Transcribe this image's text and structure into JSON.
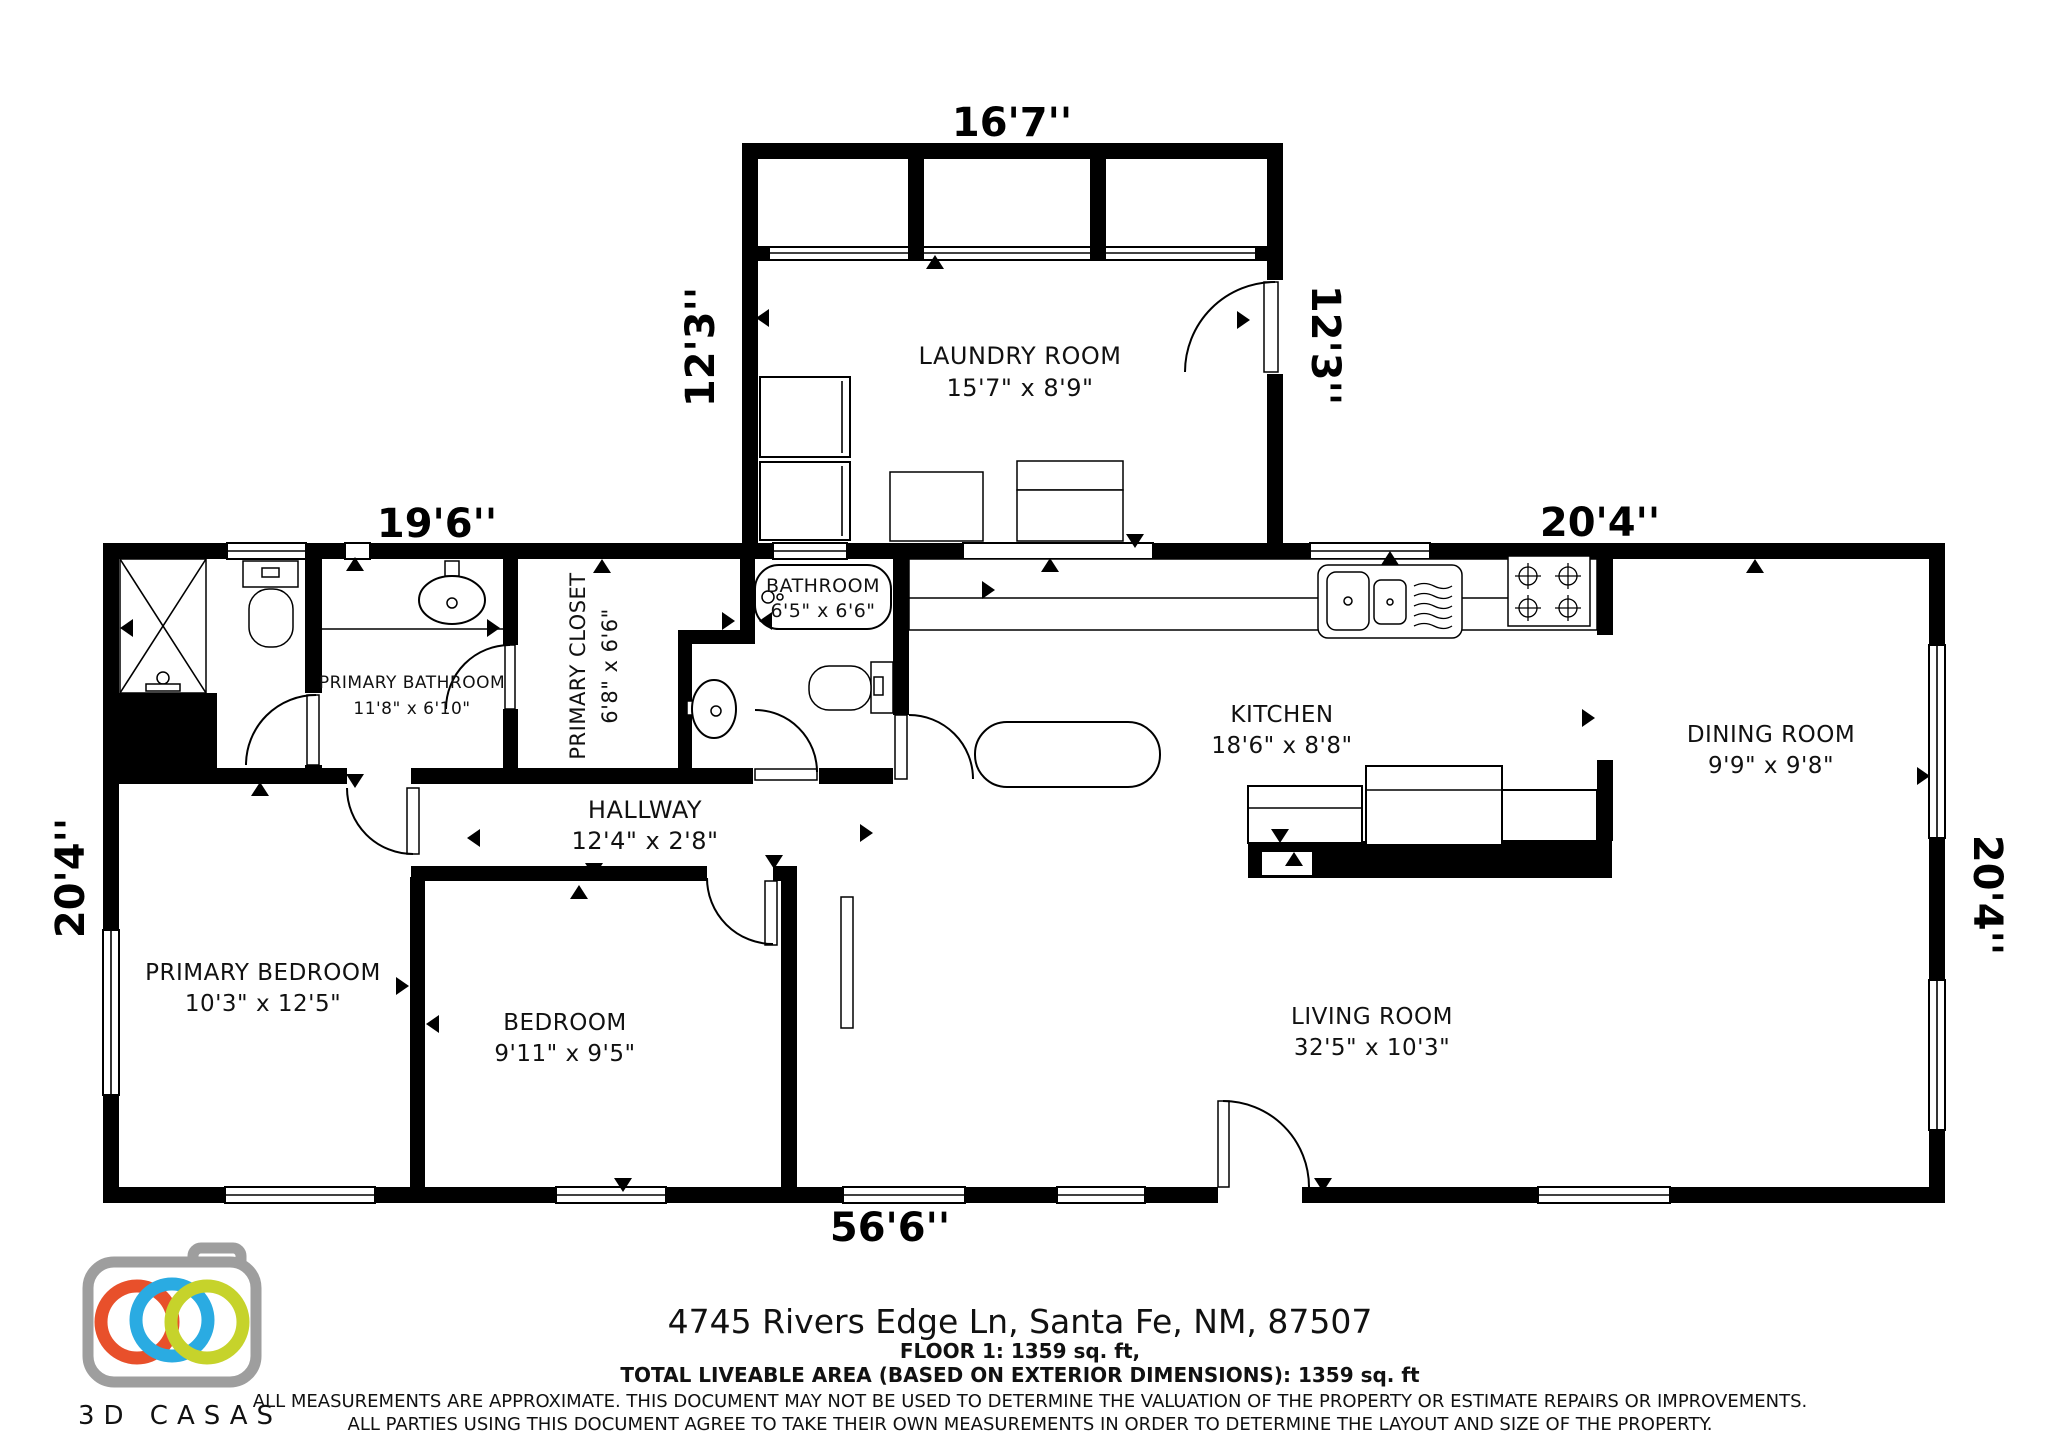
{
  "colors": {
    "wall": "#000000",
    "logo_gray": "#9e9e9e",
    "disclaimer": "#b5b5b5",
    "ring_orange": "#e8502b",
    "ring_blue": "#2aabe2",
    "ring_green": "#c6d32b"
  },
  "dimensions": {
    "laundry_top": "16'7''",
    "laundry_left": "12'3''",
    "laundry_right": "12'3''",
    "main_top_left": "19'6''",
    "main_top_right": "20'4''",
    "main_left": "20'4''",
    "main_right": "20'4''",
    "main_bottom": "56'6''"
  },
  "rooms": {
    "laundry": {
      "name": "LAUNDRY ROOM",
      "dims": "15'7\" x 8'9\""
    },
    "primary_bathroom": {
      "name": "PRIMARY BATHROOM",
      "dims": "11'8\" x 6'10\""
    },
    "primary_closet": {
      "name": "PRIMARY CLOSET",
      "dims": "6'8\" x 6'6\""
    },
    "bathroom": {
      "name": "BATHROOM",
      "dims": "6'5\" x 6'6\""
    },
    "hallway": {
      "name": "HALLWAY",
      "dims": "12'4\" x 2'8\""
    },
    "kitchen": {
      "name": "KITCHEN",
      "dims": "18'6\" x 8'8\""
    },
    "dining_room": {
      "name": "DINING ROOM",
      "dims": "9'9\" x 9'8\""
    },
    "primary_bedroom": {
      "name": "PRIMARY BEDROOM",
      "dims": "10'3\" x 12'5\""
    },
    "bedroom": {
      "name": "BEDROOM",
      "dims": "9'11\" x 9'5\""
    },
    "living_room": {
      "name": "LIVING ROOM",
      "dims": "32'5\" x 10'3\""
    }
  },
  "footer": {
    "address": "4745 Rivers Edge Ln, Santa Fe, NM, 87507",
    "floor_line": "FLOOR 1: 1359 sq. ft,",
    "total_line": "TOTAL LIVEABLE AREA (BASED ON EXTERIOR DIMENSIONS): 1359 sq. ft",
    "disclaimer_line1": "ALL MEASUREMENTS ARE APPROXIMATE. THIS DOCUMENT MAY NOT BE USED TO DETERMINE THE VALUATION OF THE PROPERTY OR ESTIMATE REPAIRS OR IMPROVEMENTS.",
    "disclaimer_line2": "ALL PARTIES USING THIS DOCUMENT AGREE TO TAKE THEIR OWN MEASUREMENTS IN ORDER TO DETERMINE THE LAYOUT AND SIZE OF THE PROPERTY."
  },
  "logo": {
    "text": "3D CASAS"
  }
}
